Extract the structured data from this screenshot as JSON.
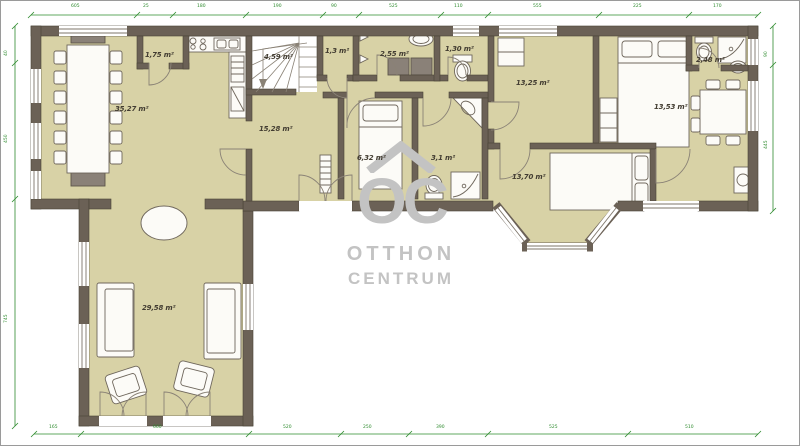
{
  "watermark": {
    "logo": "OC",
    "line1": "OTTHON",
    "line2": "CENTRUM"
  },
  "rooms": {
    "dining_kitchen": "35,27 m²",
    "pantry": "1,75 m²",
    "stairs": "4,59 m²",
    "hall": "15,28 m²",
    "closet": "1,3 m²",
    "laundry": "2,55 m²",
    "wc": "1,30 m²",
    "study": "6,32 m²",
    "bathroom": "3,1 m²",
    "bedroom1": "13,25 m²",
    "room_right": "13,53 m²",
    "bathroom2": "2,48 m²",
    "bedroom2": "13,70 m²",
    "living_room": "29,58 m²"
  },
  "dimensions": {
    "top": [
      "605",
      "25",
      "180",
      "190",
      "90",
      "525",
      "110",
      "555",
      "225",
      "170"
    ],
    "bottom": [
      "165",
      "660",
      "520",
      "250",
      "390",
      "525",
      "510"
    ],
    "left": [
      "40",
      "450",
      "745"
    ],
    "right": [
      "90",
      "445"
    ]
  },
  "colors": {
    "wall": "#6b6156",
    "floor": "#d8d2a6",
    "dimension": "#2e8b2e",
    "watermark": "#c3c3c3"
  }
}
